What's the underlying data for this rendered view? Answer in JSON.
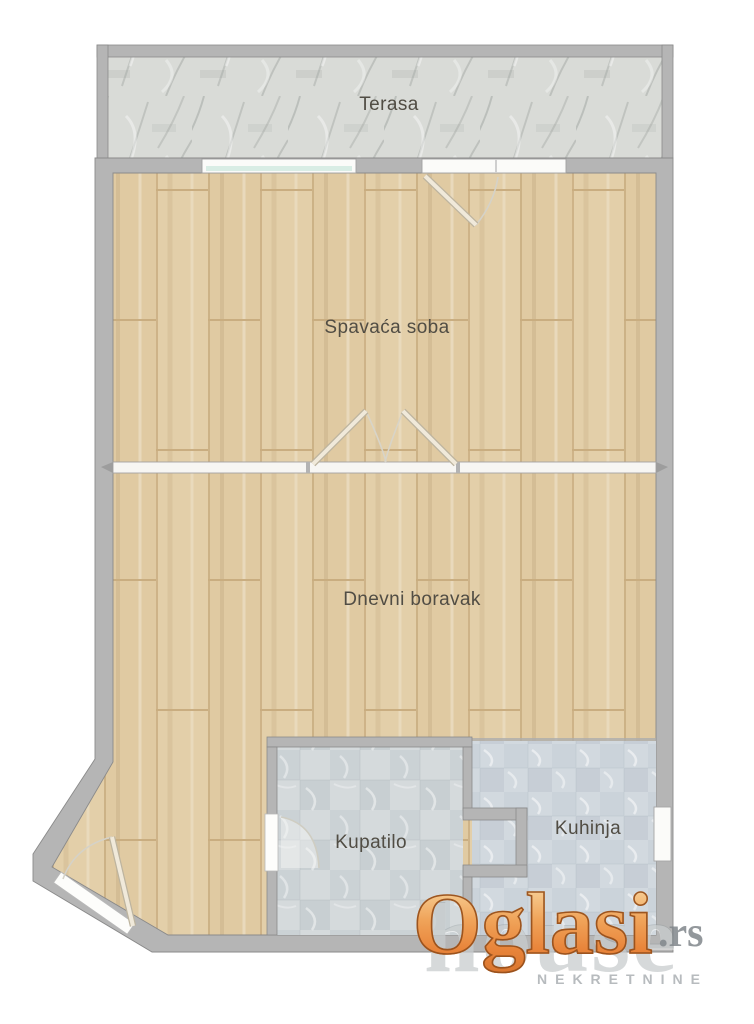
{
  "floorplan": {
    "rooms": {
      "terasa": {
        "label": "Terasa"
      },
      "spavaca_soba": {
        "label": "Spavaća soba"
      },
      "dnevni_boravak": {
        "label": "Dnevni boravak"
      },
      "kupatilo": {
        "label": "Kupatilo"
      },
      "kuhinja": {
        "label": "Kuhinja"
      }
    },
    "colors": {
      "wall_fill": "#b5b5b5",
      "wall_outline": "#8a8a8a",
      "wood_floor": "#e3cfa9",
      "terrace_floor": "#d9dbd7",
      "bathroom_floor": "#d5dadc",
      "kitchen_floor": "#d2d9df",
      "opening_white": "#fbfbf9",
      "window_glass": "#d9ede5",
      "label_text": "#514d44"
    }
  },
  "watermark": {
    "brand": "Oglasi",
    "brand_suffix": ".rs",
    "brand_color": "#ec8f3e",
    "agency_name": "house",
    "agency_tagline": "NEKRETNINE"
  }
}
